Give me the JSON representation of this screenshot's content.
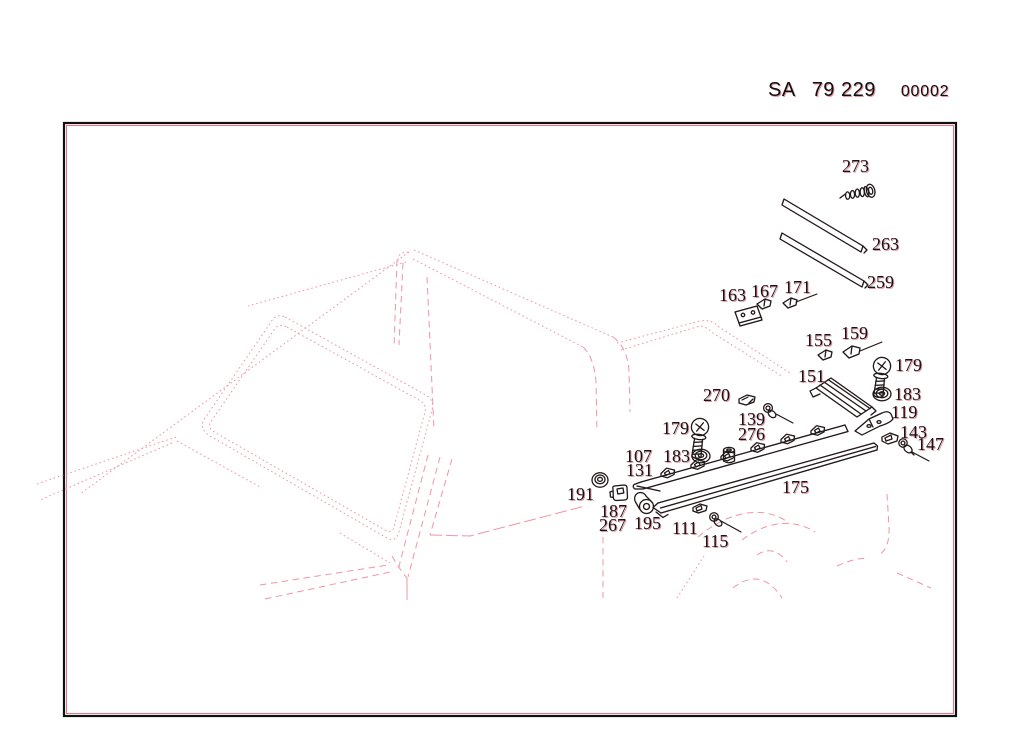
{
  "header": {
    "catalog_prefix": "SA",
    "catalog_number": "79 229",
    "sheet_code": "00002"
  },
  "colors": {
    "background": "#ffffff",
    "part_line": "#1c1c1c",
    "ghost_red": "#d62842",
    "vehicle_outline": "#f194a6",
    "frame_border": "#101010",
    "label_text": "#141414"
  },
  "diagram": {
    "frame": {
      "x": 64,
      "y": 123,
      "width": 892,
      "height": 593
    },
    "part_labels": [
      {
        "text": "273",
        "x": 842,
        "y": 159
      },
      {
        "text": "263",
        "x": 872,
        "y": 237
      },
      {
        "text": "259",
        "x": 867,
        "y": 275
      },
      {
        "text": "163",
        "x": 719,
        "y": 288
      },
      {
        "text": "167",
        "x": 751,
        "y": 284
      },
      {
        "text": "171",
        "x": 784,
        "y": 280
      },
      {
        "text": "155",
        "x": 805,
        "y": 333
      },
      {
        "text": "159",
        "x": 841,
        "y": 326
      },
      {
        "text": "179",
        "x": 895,
        "y": 358
      },
      {
        "text": "151",
        "x": 798,
        "y": 369
      },
      {
        "text": "183",
        "x": 894,
        "y": 387
      },
      {
        "text": "119",
        "x": 891,
        "y": 405
      },
      {
        "text": "143",
        "x": 900,
        "y": 425
      },
      {
        "text": "147",
        "x": 917,
        "y": 437
      },
      {
        "text": "270",
        "x": 703,
        "y": 388
      },
      {
        "text": "139",
        "x": 738,
        "y": 412
      },
      {
        "text": "276",
        "x": 738,
        "y": 427
      },
      {
        "text": "179",
        "x": 662,
        "y": 421
      },
      {
        "text": "183",
        "x": 663,
        "y": 449
      },
      {
        "text": "107",
        "x": 625,
        "y": 449
      },
      {
        "text": "131",
        "x": 626,
        "y": 463
      },
      {
        "text": "175",
        "x": 782,
        "y": 480
      },
      {
        "text": "191",
        "x": 567,
        "y": 487
      },
      {
        "text": "187",
        "x": 600,
        "y": 504
      },
      {
        "text": "267",
        "x": 599,
        "y": 518
      },
      {
        "text": "195",
        "x": 634,
        "y": 516
      },
      {
        "text": "111",
        "x": 672,
        "y": 521
      },
      {
        "text": "115",
        "x": 702,
        "y": 534
      }
    ]
  }
}
